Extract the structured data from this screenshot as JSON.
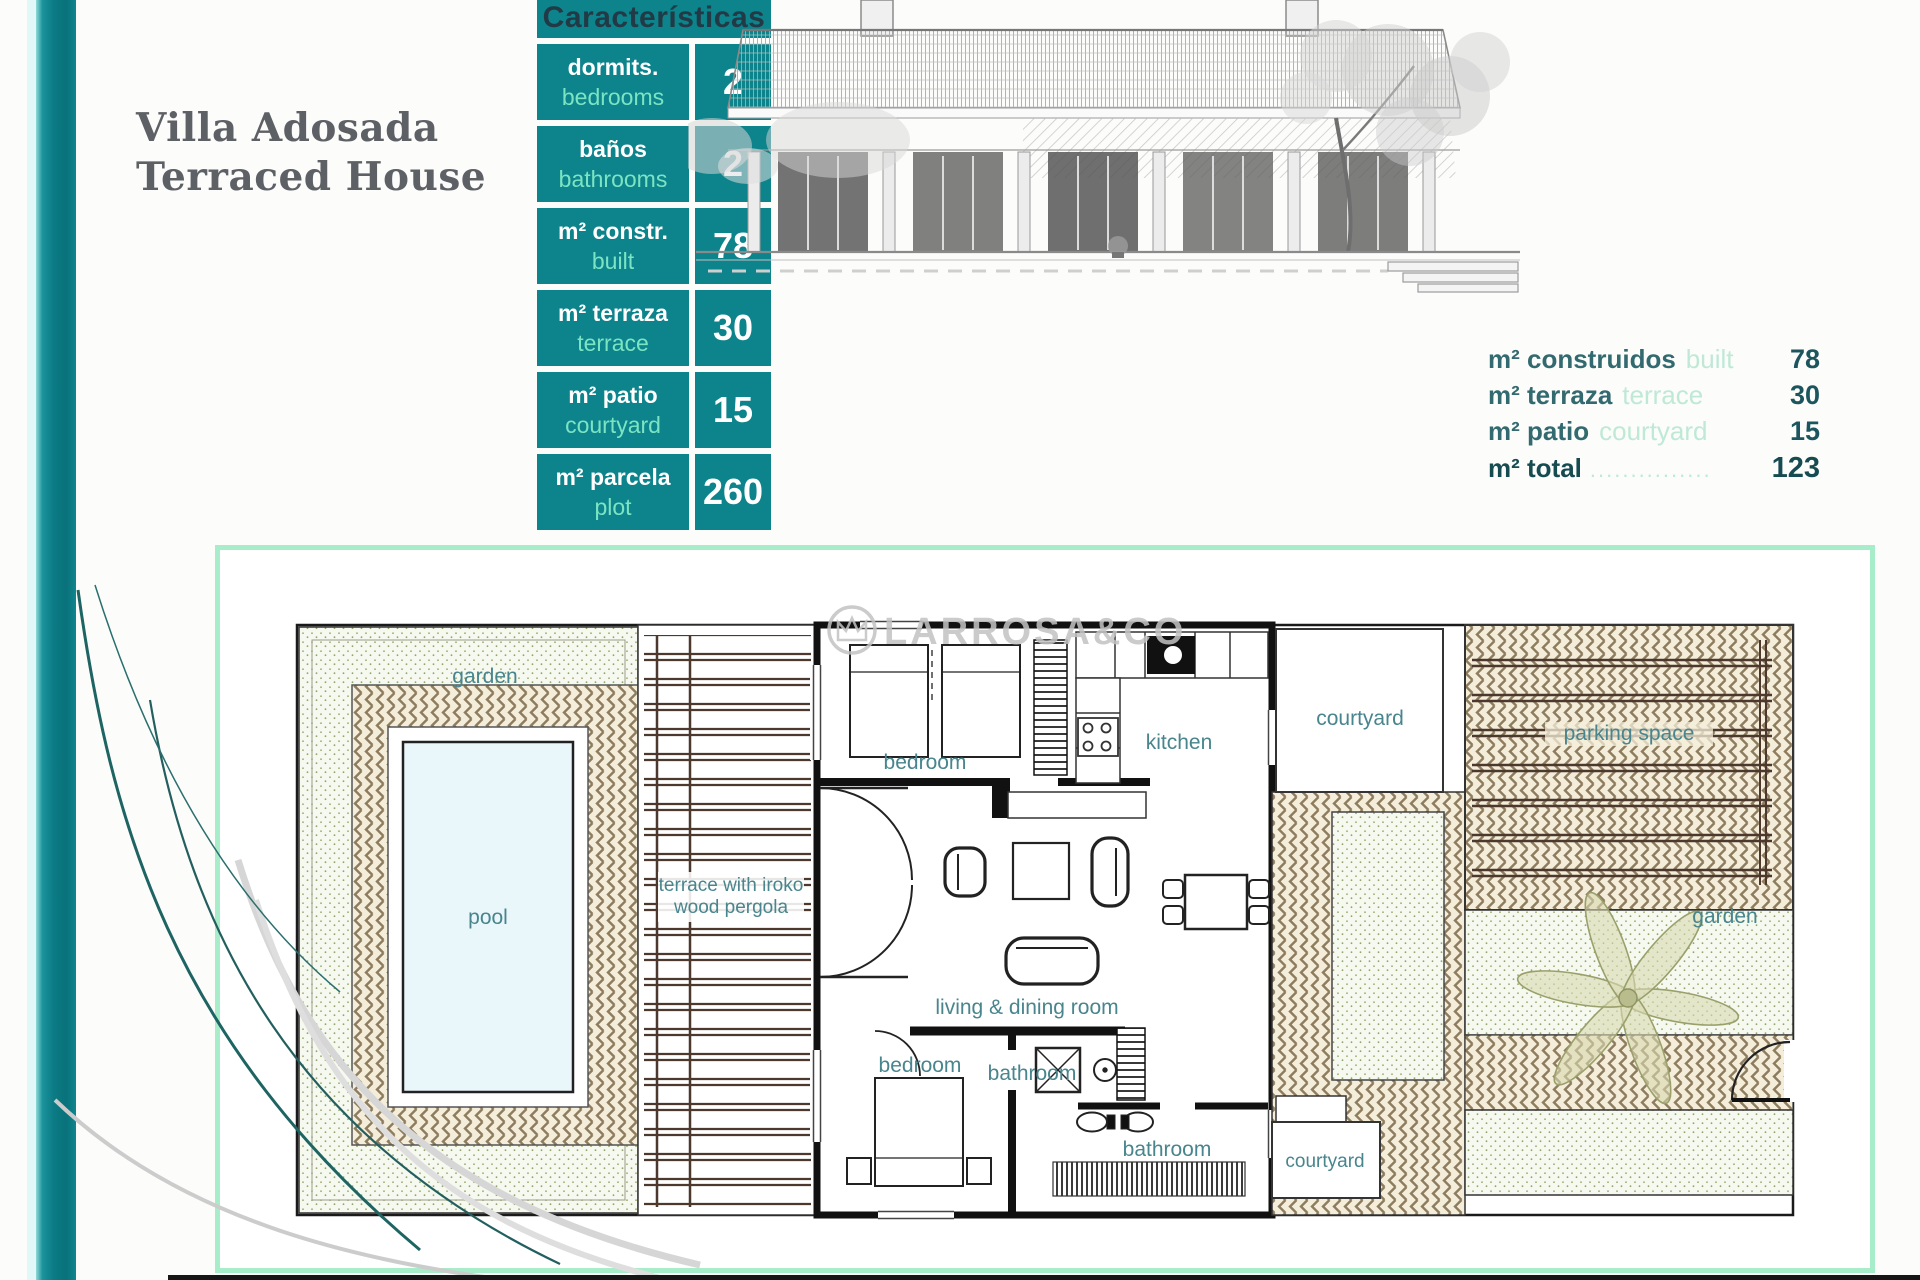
{
  "title": {
    "line1": "Villa Adosada",
    "line2": "Terraced House"
  },
  "characteristics": {
    "header": "Características",
    "rows": [
      {
        "label_es": "dormits.",
        "label_en": "bedrooms",
        "value": "2"
      },
      {
        "label_es": "baños",
        "label_en": "bathrooms",
        "value": "2"
      },
      {
        "label_es": "m² constr.",
        "label_en": "built",
        "value": "78"
      },
      {
        "label_es": "m² terraza",
        "label_en": "terrace",
        "value": "30"
      },
      {
        "label_es": "m² patio",
        "label_en": "courtyard",
        "value": "15"
      },
      {
        "label_es": "m² parcela",
        "label_en": "plot",
        "value": "260"
      }
    ]
  },
  "summary": {
    "rows": [
      {
        "label_es": "m² construidos",
        "label_en": "built",
        "leader": "",
        "value": "78"
      },
      {
        "label_es": "m² terraza",
        "label_en": "terrace",
        "leader": "",
        "value": "30"
      },
      {
        "label_es": "m² patio",
        "label_en": "courtyard",
        "leader": "",
        "value": "15"
      },
      {
        "label_es": "m² total",
        "label_en": "",
        "leader": "...............",
        "value": "123"
      }
    ]
  },
  "floor_plan": {
    "watermark": "LARROSA&CO",
    "labels": {
      "garden_left": "garden",
      "pool": "pool",
      "terrace_line1": "terrace with iroko",
      "terrace_line2": "wood pergola",
      "bedroom_top": "bedroom",
      "kitchen": "kitchen",
      "courtyard_top": "courtyard",
      "parking": "parking space",
      "living": "living & dining room",
      "bedroom_bottom": "bedroom",
      "bathroom_main": "bathroom",
      "bathroom_second": "bathroom",
      "courtyard_bottom": "courtyard",
      "garden_right": "garden"
    }
  },
  "colors": {
    "teal_cell": "#0d838b",
    "mint_text": "#7be5c3",
    "mint_border": "#a7edca",
    "plan_label_teal": "#48858d",
    "summary_text": "#336a6f",
    "summary_value": "#1d555e",
    "title_gray": "#5d6065"
  }
}
